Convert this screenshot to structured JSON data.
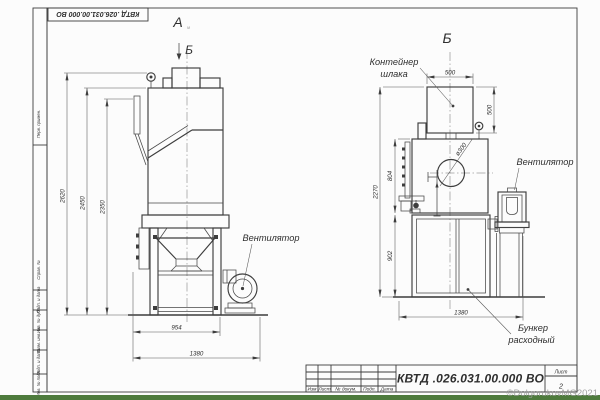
{
  "colors": {
    "line": "#3d3d3d",
    "accent_green": "#4e7b3d",
    "watermark_gray": "#9b9b9b"
  },
  "frame": {
    "side_labels": [
      "Перв. примен.",
      "Справ. №",
      "Подп. и дата",
      "Инв. № дубл.",
      "Взам. инв. №",
      "Подп. и дата",
      "Инв. № подл."
    ]
  },
  "title_block": {
    "doc_number": "КВТД .026.031.00.000  ВО",
    "columns": [
      "Изм",
      "Лист",
      "№ докум.",
      "Подп.",
      "Дата"
    ],
    "sheet_label": "Лист",
    "sheet_number": "2"
  },
  "watermark": "©DolgorukovMG2021",
  "views": {
    "a_label": "А",
    "a_sub": "м",
    "b_marker": "Б",
    "b_title": "Б"
  },
  "labels": {
    "fan": "Вентилятор",
    "container_line1": "Контейнер",
    "container_line2": "шлака",
    "bunker_line1": "Бункер",
    "bunker_line2": "расходный"
  },
  "dimensions": {
    "left": {
      "h1": "2620",
      "h2": "2450",
      "h3": "2350",
      "w1": "954",
      "w2": "1380"
    },
    "right": {
      "top_w": "500",
      "side_h": "500",
      "h1": "804",
      "h2": "2270",
      "h3": "902",
      "w1": "1380",
      "dia": "ø300"
    }
  }
}
